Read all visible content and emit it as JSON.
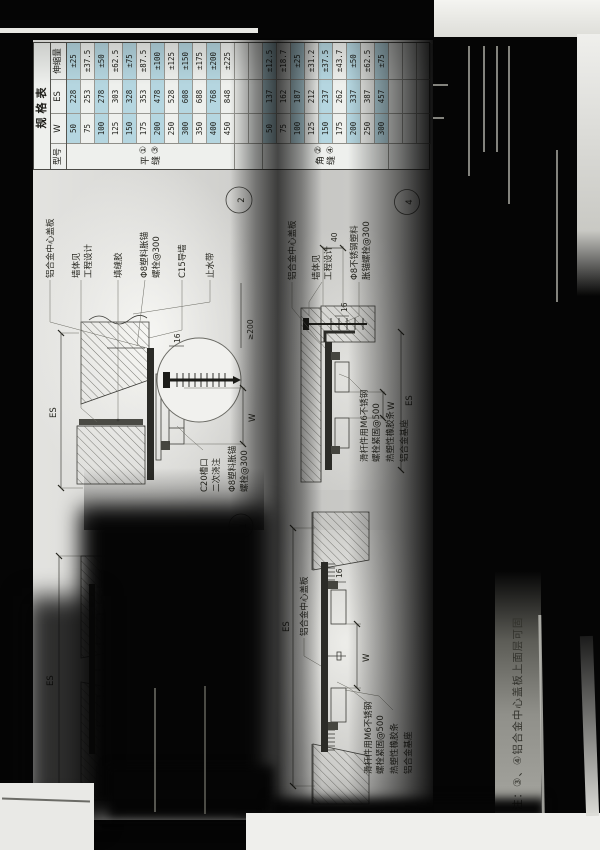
{
  "table": {
    "title": "规格表",
    "col_model": "型号",
    "col_w": "W",
    "col_es": "ES",
    "col_ext": "伸缩量",
    "group1": {
      "models": "①③",
      "joint": "平缝",
      "rows": [
        [
          "50",
          "228",
          "±25"
        ],
        [
          "75",
          "253",
          "±37.5"
        ],
        [
          "100",
          "278",
          "±50"
        ],
        [
          "125",
          "303",
          "±62.5"
        ],
        [
          "150",
          "328",
          "±75"
        ],
        [
          "175",
          "353",
          "±87.5"
        ],
        [
          "200",
          "478",
          "±100"
        ],
        [
          "250",
          "528",
          "±125"
        ],
        [
          "300",
          "608",
          "±150"
        ],
        [
          "350",
          "688",
          "±175"
        ],
        [
          "400",
          "768",
          "±200"
        ],
        [
          "450",
          "848",
          "±225"
        ]
      ]
    },
    "group2": {
      "models": "②④",
      "joint": "角缝",
      "rows": [
        [
          "50",
          "137",
          "±12.5"
        ],
        [
          "75",
          "162",
          "±18.7"
        ],
        [
          "100",
          "187",
          "±25"
        ],
        [
          "125",
          "212",
          "±31.2"
        ],
        [
          "150",
          "237",
          "±37.5"
        ],
        [
          "175",
          "262",
          "±43.7"
        ],
        [
          "200",
          "337",
          "±50"
        ],
        [
          "250",
          "387",
          "±62.5"
        ],
        [
          "300",
          "457",
          "±75"
        ]
      ]
    }
  },
  "labels": {
    "cover": "铝合金中心盖板",
    "wall1": "墙体见",
    "wall2": "工程设计",
    "sealant": "填缝胶",
    "anchor1": "Φ8塑料胀锚",
    "anchor2": "螺栓@300",
    "stagger": "(交错布置)",
    "guide": "C15导墙",
    "waterstop": "止水带",
    "slider1": "滑杆件用M6不锈钢",
    "slider2": "螺栓紧固@500",
    "rubber": "热塑性橡胶条",
    "base": "铝合金基座",
    "notch1": "C20槽口",
    "notch2": "二次浇注",
    "ss_anchor1": "Φ8不锈钢塑料",
    "ss_anchor2": "胀锚螺栓@300",
    "dim_es": "ES",
    "dim_w": "W",
    "dim_16": "16",
    "dim_40": "40",
    "dim_200": "≥200"
  },
  "details": {
    "d1_num": "1",
    "d2_num": "2",
    "d4_num": "4"
  },
  "note": "注：③、④铝合金中心盖板上面层可固"
}
